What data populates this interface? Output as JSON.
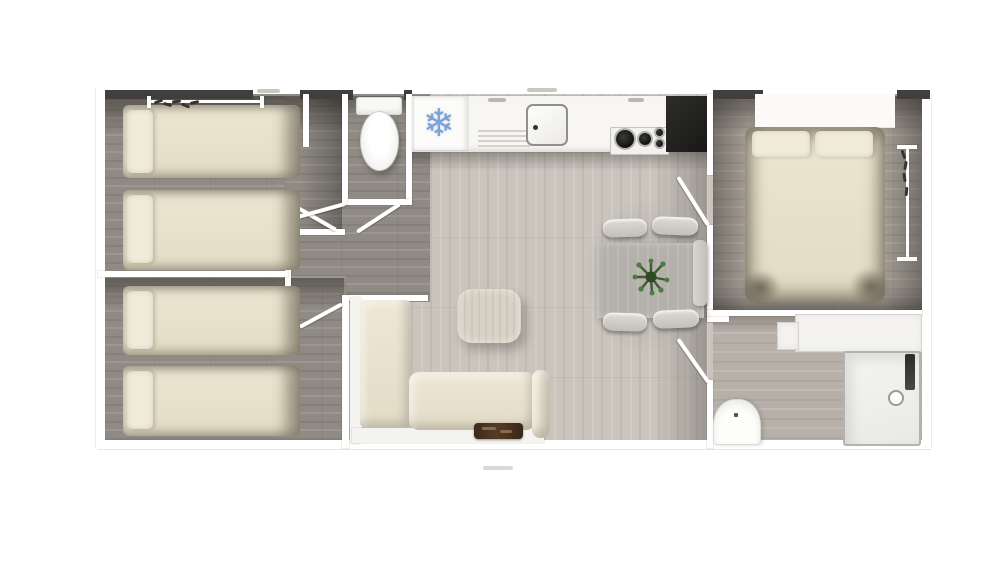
{
  "meta": {
    "kind": "3d-top-down-floor-plan-render",
    "canvas": {
      "width": 1000,
      "height": 562
    },
    "background": "#ffffff"
  },
  "glyphs": {
    "freezer_snowflake": "❄"
  },
  "palette": {
    "floor_living": "#c9c4bc",
    "floor_bedrooms": "#8f8a83",
    "floor_master": "#a29c94",
    "floor_bathroom": "#b6b0a8",
    "wall": "#ffffff",
    "wall_shadow_band": "#413e3b",
    "bed_linen": "#e9e3cd",
    "pillow": "#f1ebd9",
    "sofa": "#e8e1cf",
    "coffee_table_wood": "#d8d1c5",
    "dining_table": "#b4b0ab",
    "chair": "#d6d3ce",
    "plant_green": "#3d5c32",
    "snowflake_blue": "#7ba1d6",
    "worktop_dark": "#26241f",
    "tray_brown": "#3f2b1d"
  },
  "rooms": [
    {
      "name": "twin-bedroom-upper",
      "items": [
        "single-bed",
        "single-bed",
        "pillows",
        "wardrobe-rail-with-hangers",
        "door-open"
      ]
    },
    {
      "name": "twin-bedroom-lower",
      "items": [
        "single-bed",
        "single-bed",
        "pillows",
        "door-open"
      ]
    },
    {
      "name": "wc",
      "items": [
        "toilet",
        "door-open"
      ]
    },
    {
      "name": "kitchen",
      "items": [
        "fridge-freezer-with-snowflake",
        "drainer-vent",
        "sink",
        "gas-hob-4-burners",
        "dark-worktop",
        "cabinet-handles"
      ]
    },
    {
      "name": "living-area",
      "items": [
        "l-shaped-sofa",
        "armrest",
        "serving-tray",
        "coffee-table"
      ]
    },
    {
      "name": "dining-area",
      "items": [
        "dining-table",
        "chair",
        "chair",
        "chair",
        "chair",
        "potted-plant",
        "bench"
      ]
    },
    {
      "name": "master-bedroom",
      "items": [
        "double-bed",
        "pillow",
        "pillow",
        "wardrobe-rail-with-hangers",
        "window-bay",
        "door-open"
      ]
    },
    {
      "name": "shower-room",
      "items": [
        "shower-enclosure",
        "shower-column",
        "drain",
        "washbasin",
        "vanity-counter",
        "door-open"
      ]
    }
  ],
  "counts": {
    "single_beds": 4,
    "double_beds": 1,
    "chairs": 4,
    "doors_open": 6,
    "toilets": 1,
    "showers": 1
  }
}
